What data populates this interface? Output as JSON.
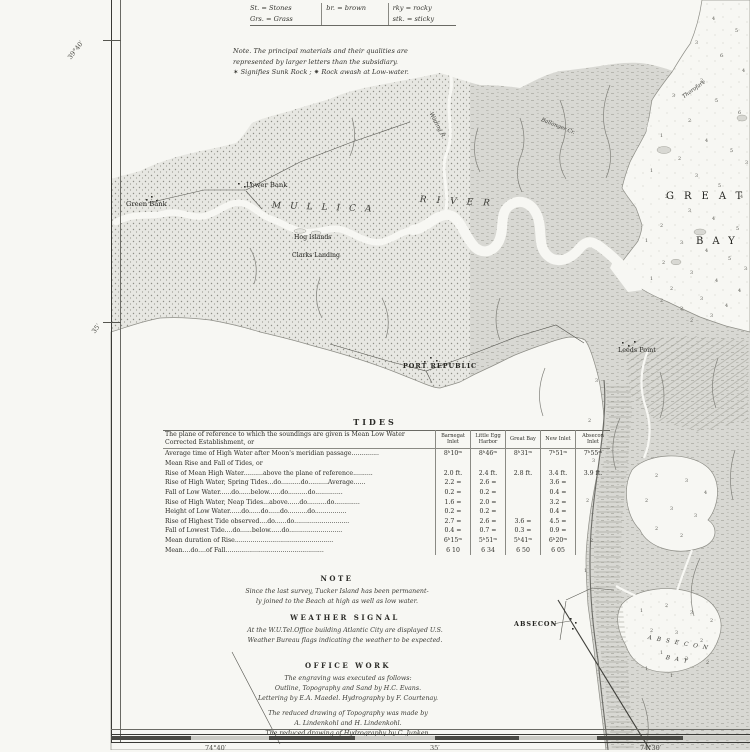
{
  "materials_key": {
    "rows": [
      [
        "St. = Stones",
        "br. = brown",
        "rky = rocky"
      ],
      [
        "Grs. = Grass",
        "",
        "stk. = sticky"
      ]
    ],
    "note_lines": [
      "Note. The principal materials and their qualities are",
      "represented by larger letters than the subsidiary.",
      "✶ Signifies Sunk Rock ;   ✷ Rock awash at Low-water."
    ]
  },
  "tides": {
    "title": "TIDES",
    "intro_lines": [
      "The plane of reference to which the soundings are given is Mean Low Water",
      "Corrected Establishment, or"
    ],
    "columns": [
      [
        "Barnegat",
        "Inlet"
      ],
      [
        "Little Egg",
        "Harbor"
      ],
      [
        "Great Bay"
      ],
      [
        "New Inlet"
      ],
      [
        "Absecon",
        "Inlet"
      ]
    ],
    "rows": [
      {
        "label": "Average time of High Water after Moon's meridian passage..............",
        "values": [
          "8ʰ10ᵐ",
          "8ʰ46ᵐ",
          "8ʰ31ᵐ",
          "7ʰ51ᵐ",
          "7ʰ55ᵐ"
        ]
      },
      {
        "label": "Mean Rise and Fall of Tides, or",
        "values": [
          "",
          "",
          "",
          "",
          ""
        ]
      },
      {
        "label": "Rise of Mean High Water..........above the plane of reference..........",
        "values": [
          "2.0 ft.",
          "2.4 ft.",
          "2.8 ft.",
          "3.4 ft.",
          "3.9 ft."
        ]
      },
      {
        "label": "Rise of High Water, Spring Tides...do..........do..........Average......",
        "values": [
          "2.2 =",
          "2.6 =",
          "",
          "3.6 =",
          ""
        ]
      },
      {
        "label": "Fall of Low Water......do......below......do..........do..............",
        "values": [
          "0.2 =",
          "0.2 =",
          "",
          "0.4 =",
          ""
        ]
      },
      {
        "label": "Rise of High Water, Neap Tides...above......do..........do.............",
        "values": [
          "1.6 =",
          "2.0 =",
          "",
          "3.2 =",
          ""
        ]
      },
      {
        "label": "Height of Low Water......do......do......do..........do................",
        "values": [
          "0.2 =",
          "0.2 =",
          "",
          "0.4 =",
          ""
        ]
      },
      {
        "label": "Rise of Highest Tide observed....do......do............................",
        "values": [
          "2.7 =",
          "2.6 =",
          "3.6 =",
          "4.5 =",
          ""
        ]
      },
      {
        "label": "Fall of Lowest Tide....do......below......do...........................",
        "values": [
          "0.4 =",
          "0.7 =",
          "0.3 =",
          "0.9 =",
          ""
        ]
      },
      {
        "label": "Mean duration of Rise..................................................",
        "values": [
          "6ʰ15ᵐ",
          "5ʰ51ᵐ",
          "5ʰ41ᵐ",
          "6ʰ20ᵐ",
          ""
        ]
      },
      {
        "label": "Mean....do....of Fall..................................................",
        "values": [
          "6 10",
          "6 34",
          "6 50",
          "6 05",
          ""
        ]
      }
    ]
  },
  "note_section": {
    "heading": "NOTE",
    "lines": [
      "Since the last survey, Tucker Island has been permanent-",
      "ly joined to the Beach at high as well as low water."
    ]
  },
  "weather_section": {
    "heading": "WEATHER SIGNAL",
    "lines": [
      "At the W.U.Tel.Office building Atlantic City are displayed U.S.",
      "Weather Bureau flags indicating the weather to be expected."
    ]
  },
  "office_section": {
    "heading": "OFFICE WORK",
    "lines": [
      "The engraving was executed as follows:",
      "Outline, Topography and Sand by H.C. Evans.",
      "Lettering by E.A. Maedel. Hydrography by F. Courtenay.",
      "",
      "The reduced drawing of Topography was made by",
      "A. Lindenkohl and H. Lindenkohl.",
      "The reduced drawing of Hydrography by C. Junken."
    ]
  },
  "margins": {
    "lat_top": "39°40′",
    "lat_mid": "35′",
    "lon_left": "74°40′",
    "lon_mid": "35′",
    "lon_right": "74°30′"
  },
  "map": {
    "colors": {
      "paper": "#f7f7f3",
      "upland": "#e7e7e2",
      "marsh": "#d8d8d3",
      "ink": "#2b2b27"
    },
    "labels": [
      {
        "id": "green-bank",
        "text": "Green Bank",
        "x": 126,
        "y": 201,
        "s": 6.8,
        "cls": "lbl-place"
      },
      {
        "id": "lower-bank",
        "text": "Lower Bank",
        "x": 246,
        "y": 182,
        "s": 6.8,
        "cls": "lbl-place"
      },
      {
        "id": "hog-islands",
        "text": "Hog Islands",
        "x": 294,
        "y": 235,
        "s": 6.2,
        "cls": "lbl-place"
      },
      {
        "id": "clarks-landing",
        "text": "Clarks Landing",
        "x": 292,
        "y": 253,
        "s": 6.2,
        "cls": "lbl-place"
      },
      {
        "id": "mullica",
        "text": "MULLICA",
        "x": 272,
        "y": 202,
        "s": 9,
        "ls": 9,
        "rot": 2,
        "cls": "lbl-water"
      },
      {
        "id": "river",
        "text": "RIVER",
        "x": 420,
        "y": 196,
        "s": 9,
        "ls": 10,
        "rot": 3,
        "cls": "lbl-water"
      },
      {
        "id": "wading-river",
        "text": "Wading R.",
        "x": 432,
        "y": 112,
        "s": 5.6,
        "rot": 62,
        "cls": "lbl-water"
      },
      {
        "id": "ballanger-cr",
        "text": "Ballanger Cr.",
        "x": 542,
        "y": 118,
        "s": 5.4,
        "rot": 22,
        "cls": "lbl-water"
      },
      {
        "id": "thorofare",
        "text": "Thorofare",
        "x": 682,
        "y": 96,
        "s": 5.4,
        "rot": -36,
        "cls": "lbl-water"
      },
      {
        "id": "great",
        "text": "GREAT",
        "x": 666,
        "y": 192,
        "s": 10,
        "ls": 10,
        "cls": "lbl-place"
      },
      {
        "id": "bay",
        "text": "BAY",
        "x": 696,
        "y": 237,
        "s": 10,
        "ls": 9,
        "cls": "lbl-place"
      },
      {
        "id": "port-republic",
        "text": "PORT REPUBLIC",
        "x": 403,
        "y": 363,
        "s": 6.4,
        "ls": 1,
        "cls": "lbl-caps"
      },
      {
        "id": "leeds-point",
        "text": "Leeds Point",
        "x": 618,
        "y": 347,
        "s": 6.4,
        "cls": "lbl-place"
      },
      {
        "id": "absecon",
        "text": "ABSECON",
        "x": 514,
        "y": 621,
        "s": 6.4,
        "ls": 1,
        "cls": "lbl-caps"
      },
      {
        "id": "absecon-bay-1",
        "text": "ABSECON",
        "x": 648,
        "y": 636,
        "s": 5.8,
        "ls": 5,
        "rot": 10,
        "cls": "lbl-water"
      },
      {
        "id": "absecon-bay-2",
        "text": "BAY",
        "x": 666,
        "y": 656,
        "s": 5.8,
        "ls": 5,
        "rot": 10,
        "cls": "lbl-water"
      }
    ],
    "soundings": [
      [
        712,
        18,
        "4"
      ],
      [
        735,
        30,
        "5"
      ],
      [
        695,
        42,
        "3"
      ],
      [
        720,
        55,
        "6"
      ],
      [
        742,
        70,
        "4"
      ],
      [
        700,
        80,
        "2"
      ],
      [
        672,
        95,
        "3"
      ],
      [
        715,
        100,
        "5"
      ],
      [
        738,
        112,
        "6"
      ],
      [
        688,
        120,
        "2"
      ],
      [
        660,
        135,
        "1"
      ],
      [
        705,
        140,
        "4"
      ],
      [
        730,
        150,
        "5"
      ],
      [
        745,
        162,
        "3"
      ],
      [
        678,
        158,
        "2"
      ],
      [
        650,
        170,
        "1"
      ],
      [
        695,
        175,
        "3"
      ],
      [
        718,
        185,
        "5"
      ],
      [
        740,
        196,
        "4"
      ],
      [
        665,
        196,
        "2"
      ],
      [
        688,
        210,
        "3"
      ],
      [
        712,
        218,
        "4"
      ],
      [
        736,
        228,
        "5"
      ],
      [
        660,
        225,
        "2"
      ],
      [
        645,
        240,
        "1"
      ],
      [
        680,
        242,
        "3"
      ],
      [
        705,
        250,
        "4"
      ],
      [
        728,
        258,
        "5"
      ],
      [
        744,
        268,
        "3"
      ],
      [
        662,
        262,
        "2"
      ],
      [
        690,
        272,
        "3"
      ],
      [
        715,
        280,
        "4"
      ],
      [
        738,
        290,
        "4"
      ],
      [
        670,
        288,
        "2"
      ],
      [
        650,
        278,
        "1"
      ],
      [
        700,
        298,
        "3"
      ],
      [
        725,
        305,
        "4"
      ],
      [
        680,
        308,
        "2"
      ],
      [
        660,
        300,
        "2"
      ],
      [
        710,
        315,
        "3"
      ],
      [
        690,
        320,
        "2"
      ],
      [
        595,
        380,
        "3"
      ],
      [
        588,
        420,
        "2"
      ],
      [
        592,
        460,
        "3"
      ],
      [
        586,
        500,
        "2"
      ],
      [
        590,
        540,
        "2"
      ],
      [
        584,
        570,
        "1"
      ],
      [
        655,
        475,
        "2"
      ],
      [
        685,
        480,
        "3"
      ],
      [
        704,
        492,
        "4"
      ],
      [
        645,
        500,
        "2"
      ],
      [
        670,
        508,
        "3"
      ],
      [
        694,
        515,
        "3"
      ],
      [
        655,
        528,
        "2"
      ],
      [
        680,
        535,
        "2"
      ],
      [
        640,
        610,
        "1"
      ],
      [
        665,
        605,
        "2"
      ],
      [
        690,
        612,
        "3"
      ],
      [
        710,
        620,
        "2"
      ],
      [
        650,
        630,
        "2"
      ],
      [
        675,
        632,
        "3"
      ],
      [
        700,
        640,
        "2"
      ],
      [
        660,
        652,
        "1"
      ],
      [
        685,
        658,
        "2"
      ],
      [
        706,
        662,
        "2"
      ],
      [
        670,
        675,
        "1"
      ],
      [
        645,
        668,
        "1"
      ]
    ]
  }
}
